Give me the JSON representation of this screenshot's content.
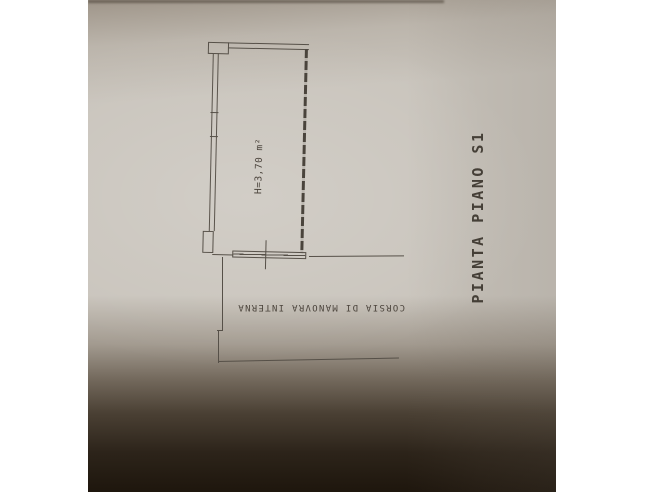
{
  "photo": {
    "paper_color": "#c9c4bc",
    "line_color": "#565048",
    "shadow_color": "#281f14",
    "text_color": "#4a433b"
  },
  "plan": {
    "title": "PIANTA PIANO S1",
    "room_height_label": "H=3,70 m²",
    "lane_label": "CORSIA DI MANOVRA INTERNA"
  }
}
